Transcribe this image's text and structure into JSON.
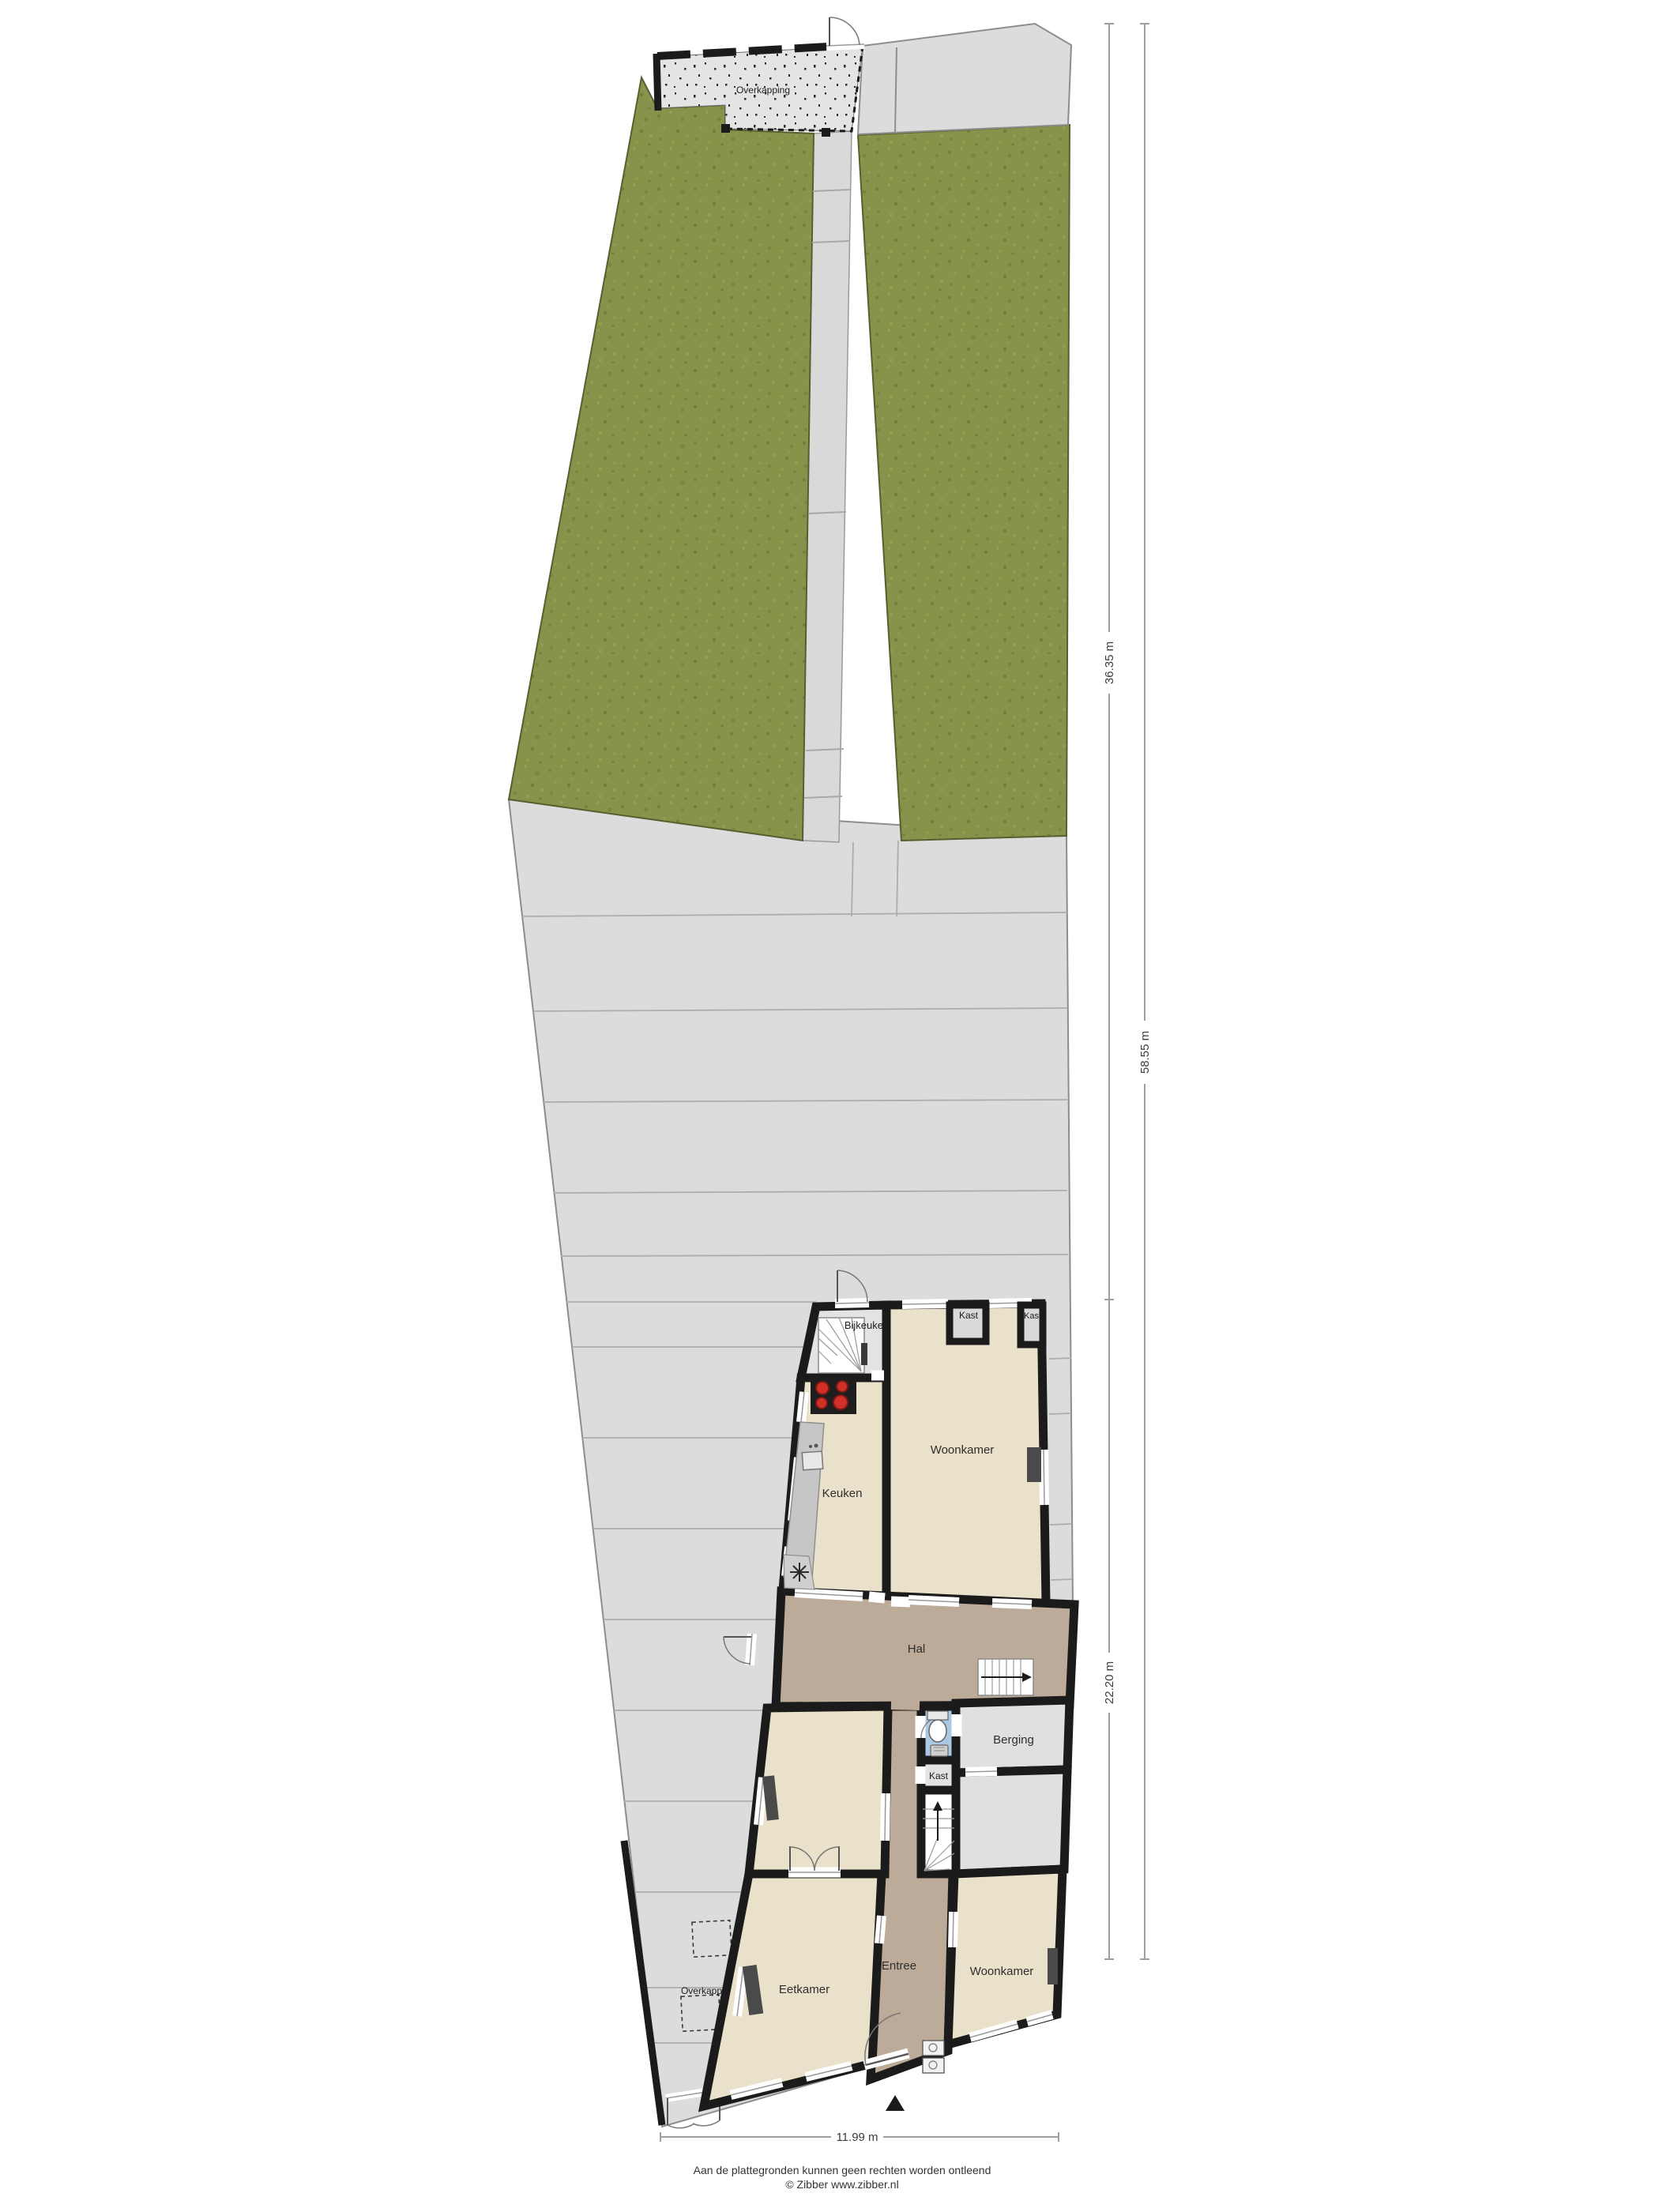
{
  "plan": {
    "type": "ground-floor-plan-with-garden"
  },
  "labels": {
    "overkapping_top": "Overkapping",
    "overkapping_side": "Overkapping",
    "bijkeuken": "Bijkeuken",
    "keuken": "Keuken",
    "woonkamer_top": "Woonkamer",
    "kast_top": "Kast",
    "kast_corner": "Kast",
    "hal": "Hal",
    "berging": "Berging",
    "kast_mid": "Kast",
    "eetkamer": "Eetkamer",
    "entree": "Entree",
    "woonkamer_bottom": "Woonkamer"
  },
  "dimensions": {
    "garden_depth": "36.35 m",
    "house_depth": "22.20 m",
    "total_depth": "58.55 m",
    "width": "11.99 m"
  },
  "footer": {
    "disclaimer": "Aan de plattegronden kunnen geen rechten worden ontleend",
    "credit": "© Zibber www.zibber.nl"
  },
  "colors": {
    "grass": "#87934a",
    "paving": "#dcdcdc",
    "path": "#d9d9d9",
    "overkapping": "#e4e4e4",
    "room": "#eae1ca",
    "hall": "#bcab98",
    "utility": "#e3e3e3",
    "storage": "#e0e0e0",
    "toilet": "#aac7e3",
    "wall": "#1b1b1b",
    "counter": "#c6c6c6",
    "burner": "#d03028"
  }
}
